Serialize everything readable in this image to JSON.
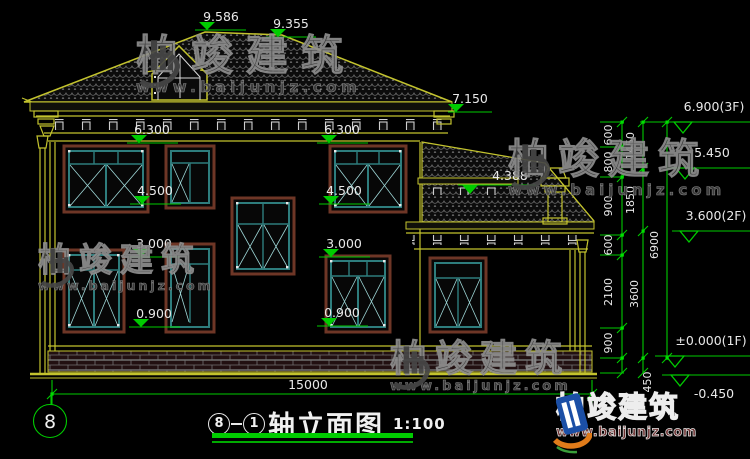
{
  "watermark": {
    "brand": "柏竣建筑",
    "url": "www.baijunjz.com"
  },
  "logo": {
    "brand": "柏竣建筑",
    "url": "www.baijunjz.com"
  },
  "title": {
    "axis_from": "8",
    "axis_to": "1",
    "text": "轴立面图",
    "scale": "1:100"
  },
  "axis_bubble": "8",
  "dims": {
    "ridge_left": "9.586",
    "ridge_right": "9.355",
    "main_eave": "7.150",
    "soffit_left": "6.300",
    "soffit_right": "6.300",
    "sill2f_left": "4.500",
    "sill2f_right": "4.500",
    "annex_eave": "4.388",
    "top1f_left": "3.000",
    "top1f_right": "3.000",
    "sill1f_left": "0.900",
    "sill1f_right": "0.900",
    "width_total": "15000"
  },
  "levels": {
    "l3f": "6.900(3F)",
    "l545": "5.450",
    "l2f": "3.600(2F)",
    "l1f": "±0.000(1F)",
    "lm045": "-0.450"
  },
  "vchain": {
    "c1": [
      "600",
      "800",
      "900",
      "600",
      "2100",
      "900"
    ],
    "c2": [
      "1450",
      "1850",
      "3600"
    ],
    "c3": [
      "6900"
    ],
    "below": "450"
  },
  "colors": {
    "background": "#000000",
    "cad_yellow": "#c3c32e",
    "dim_green": "#00cc00",
    "window_teal": "#2e7d7d",
    "window_surround_brown": "#6e3626",
    "text_white": "#e8e8e8",
    "logo_blue": "#1b4fa6",
    "logo_orange": "#e07b1a"
  }
}
